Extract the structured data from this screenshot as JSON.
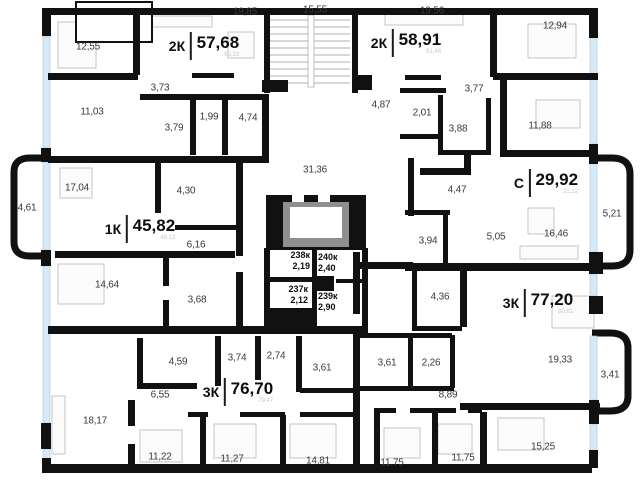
{
  "plan_type": "residential-floor-plan",
  "colors": {
    "wall": "#111111",
    "window": "#d5e9f7",
    "window_border": "#a9c6dc",
    "furniture": "#cfcfcf",
    "label_text": "#3a3a3a",
    "unit_text": "#0d0d0d",
    "faint_text": "#c8c8c8",
    "elevator_frame": "#8f8f8f"
  },
  "units": [
    {
      "code": "2К",
      "area": "57,68",
      "area_sub": "60,23",
      "x": 204,
      "y": 46
    },
    {
      "code": "2К",
      "area": "58,91",
      "area_sub": "61,46",
      "x": 406,
      "y": 43
    },
    {
      "code": "1К",
      "area": "45,82",
      "area_sub": "48,13",
      "x": 140,
      "y": 229
    },
    {
      "code": "С",
      "area": "29,92",
      "area_sub": "31,12",
      "x": 546,
      "y": 183
    },
    {
      "code": "3К",
      "area": "76,70",
      "area_sub": "79,47",
      "x": 238,
      "y": 392
    },
    {
      "code": "3К",
      "area": "77,20",
      "area_sub": "80,61",
      "x": 538,
      "y": 303
    }
  ],
  "rooms": [
    {
      "label": "12,55",
      "x": 88,
      "y": 47
    },
    {
      "label": "19,85",
      "x": 245,
      "y": 12
    },
    {
      "label": "3,73",
      "x": 160,
      "y": 88
    },
    {
      "label": "11,03",
      "x": 92,
      "y": 112
    },
    {
      "label": "3,79",
      "x": 174,
      "y": 128
    },
    {
      "label": "1,99",
      "x": 209,
      "y": 117
    },
    {
      "label": "4,74",
      "x": 248,
      "y": 118
    },
    {
      "label": "19,56",
      "x": 432,
      "y": 11
    },
    {
      "label": "12,94",
      "x": 555,
      "y": 26
    },
    {
      "label": "4,87",
      "x": 381,
      "y": 105
    },
    {
      "label": "3,77",
      "x": 474,
      "y": 89
    },
    {
      "label": "2,01",
      "x": 422,
      "y": 113
    },
    {
      "label": "3,88",
      "x": 458,
      "y": 129
    },
    {
      "label": "11,88",
      "x": 540,
      "y": 126
    },
    {
      "label": "17,04",
      "x": 77,
      "y": 188
    },
    {
      "label": "4,30",
      "x": 186,
      "y": 191
    },
    {
      "label": "6,16",
      "x": 196,
      "y": 245
    },
    {
      "label": "14,64",
      "x": 107,
      "y": 285
    },
    {
      "label": "3,68",
      "x": 197,
      "y": 300
    },
    {
      "label": "4,47",
      "x": 457,
      "y": 190
    },
    {
      "label": "3,94",
      "x": 428,
      "y": 241
    },
    {
      "label": "5,05",
      "x": 496,
      "y": 237
    },
    {
      "label": "16,46",
      "x": 556,
      "y": 234
    },
    {
      "label": "4,59",
      "x": 178,
      "y": 362
    },
    {
      "label": "3,74",
      "x": 237,
      "y": 358
    },
    {
      "label": "2,74",
      "x": 276,
      "y": 356
    },
    {
      "label": "3,61",
      "x": 322,
      "y": 368
    },
    {
      "label": "6,55",
      "x": 160,
      "y": 395
    },
    {
      "label": "18,17",
      "x": 95,
      "y": 421
    },
    {
      "label": "11,22",
      "x": 160,
      "y": 457
    },
    {
      "label": "11,27",
      "x": 232,
      "y": 459
    },
    {
      "label": "14,81",
      "x": 318,
      "y": 461
    },
    {
      "label": "4,36",
      "x": 440,
      "y": 297
    },
    {
      "label": "3,61",
      "x": 387,
      "y": 363
    },
    {
      "label": "2,26",
      "x": 431,
      "y": 363
    },
    {
      "label": "8,89",
      "x": 448,
      "y": 395
    },
    {
      "label": "19,33",
      "x": 560,
      "y": 360
    },
    {
      "label": "11,75",
      "x": 392,
      "y": 463
    },
    {
      "label": "11,75",
      "x": 463,
      "y": 458
    },
    {
      "label": "15,25",
      "x": 543,
      "y": 447
    }
  ],
  "common_areas": [
    {
      "name": "corridor",
      "label": "31,36",
      "x": 315,
      "y": 170
    },
    {
      "name": "staircase",
      "label": "15,55",
      "x": 315,
      "y": 10
    }
  ],
  "balconies": [
    {
      "label": "4,61",
      "x": 27,
      "y": 208
    },
    {
      "label": "5,21",
      "x": 612,
      "y": 214
    },
    {
      "label": "3,41",
      "x": 610,
      "y": 375
    }
  ],
  "storage_units": [
    {
      "num": "238к",
      "area": "2,19",
      "x": 272,
      "y": 250,
      "w": 38,
      "align": "right"
    },
    {
      "num": "240к",
      "area": "2,40",
      "x": 318,
      "y": 252,
      "w": 38,
      "align": "left"
    },
    {
      "num": "237к",
      "area": "2,12",
      "x": 266,
      "y": 284,
      "w": 42,
      "align": "right"
    },
    {
      "num": "239к",
      "area": "2,90",
      "x": 318,
      "y": 291,
      "w": 38,
      "align": "left"
    }
  ]
}
